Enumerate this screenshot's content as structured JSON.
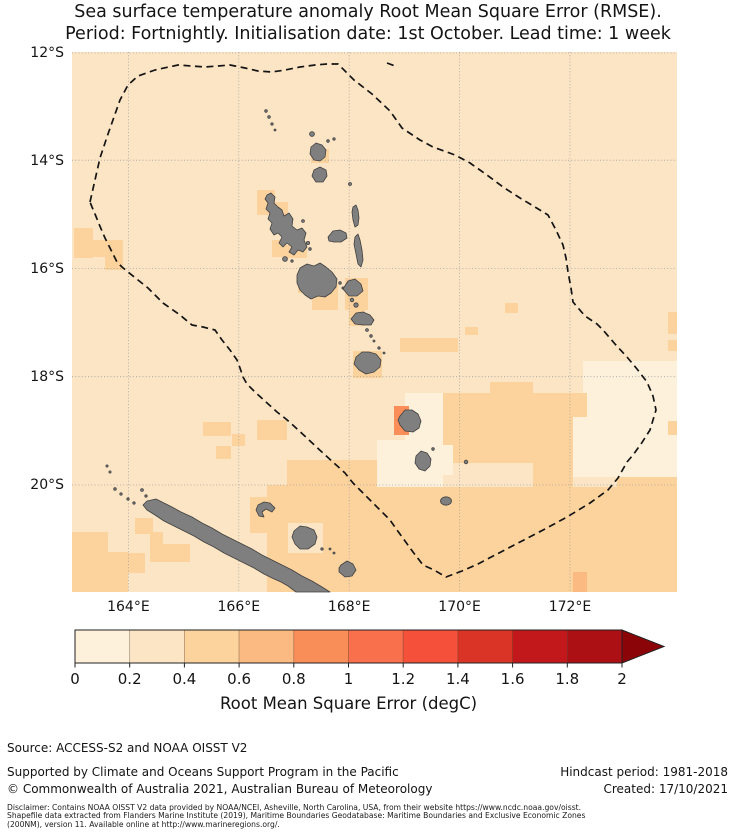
{
  "figure": {
    "title_line1": "Sea surface temperature anomaly Root Mean Square Error (RMSE).",
    "title_line2": "Period: Fortnightly. Initialisation date: 1st October. Lead time: 1 week"
  },
  "map": {
    "lat_labels": [
      "12°S",
      "14°S",
      "16°S",
      "18°S",
      "20°S"
    ],
    "lon_labels": [
      "164°E",
      "166°E",
      "168°E",
      "170°E",
      "172°E"
    ],
    "colors": {
      "ocean_base": "#FCE5C5",
      "patch_mid": "#FCD39D",
      "patch_pale": "#FDF1DC",
      "patch_high": "#FA8E59",
      "patch_midhigh": "#FBBA82",
      "island_fill": "#7F7F7F",
      "island_outline": "#404040",
      "eez_line": "#141414",
      "gridline": "#9A9A9A"
    }
  },
  "colorbar": {
    "tick_labels": [
      "0",
      "0.2",
      "0.4",
      "0.6",
      "0.8",
      "1",
      "1.2",
      "1.4",
      "1.6",
      "1.8",
      "2"
    ],
    "label": "Root Mean Square Error (degC)",
    "colors": [
      "#FDF1DC",
      "#FCE5C5",
      "#FCD39D",
      "#FBBA82",
      "#FA8E59",
      "#F8704C",
      "#F4503A",
      "#D93426",
      "#C2181C",
      "#AC0F14"
    ],
    "arrow_color": "#8B0508"
  },
  "footer": {
    "source": "Source: ACCESS-S2 and NOAA OISST V2",
    "supported": "Supported by Climate and Oceans Support Program in the Pacific",
    "copyright": "© Commonwealth of Australia 2021, Australian Bureau of Meteorology",
    "hindcast": "Hindcast period: 1981-2018",
    "created": "Created: 17/10/2021",
    "disclaimer_lines": [
      "Disclaimer: Contains NOAA OISST V2 data provided by NOAA/NCEI, Asheville, North Carolina, USA, from their website https://www.ncdc.noaa.gov/oisst.",
      "Shapefile data extracted from Flanders Marine Institute (2019), Maritime Boundaries Geodatabase: Maritime Boundaries and Exclusive Economic Zones",
      "(200NM), version 11. Available online at http://www.marineregions.org/."
    ]
  },
  "chart_data": {
    "type": "heatmap",
    "title": "Sea surface temperature anomaly RMSE, fortnightly period, initialisation 1st October, lead time 1 week",
    "region": "Vanuatu EEZ and surrounds (approx 163°E–174°E, 12°S–22°S)",
    "x_ticks": [
      "164°E",
      "166°E",
      "168°E",
      "170°E",
      "172°E"
    ],
    "y_ticks": [
      "12°S",
      "14°S",
      "16°S",
      "18°S",
      "20°S"
    ],
    "colorbar": {
      "min": 0,
      "max": 2,
      "step": 0.2,
      "extend": "max",
      "label": "Root Mean Square Error (degC)"
    },
    "values_summary": [
      {
        "area": "most open ocean",
        "rmse_degC": "0.2–0.4"
      },
      {
        "area": "scattered island/coastal cells and large south-east + south-west blocks",
        "rmse_degC": "0.4–0.6"
      },
      {
        "area": "pale pockets east of Vanuatu EEZ vertex and around southern island column",
        "rmse_degC": "0.0–0.2"
      },
      {
        "area": "single cell west of Erromango island",
        "rmse_degC": "0.8–1.0"
      },
      {
        "area": "single cell near 172°E, 21.5°S",
        "rmse_degC": "0.6–0.8"
      }
    ],
    "overlays": [
      "dashed EEZ boundary polygon",
      "grey island landmasses (Vanuatu archipelago, New Caledonia, Loyalty Islands)"
    ]
  }
}
